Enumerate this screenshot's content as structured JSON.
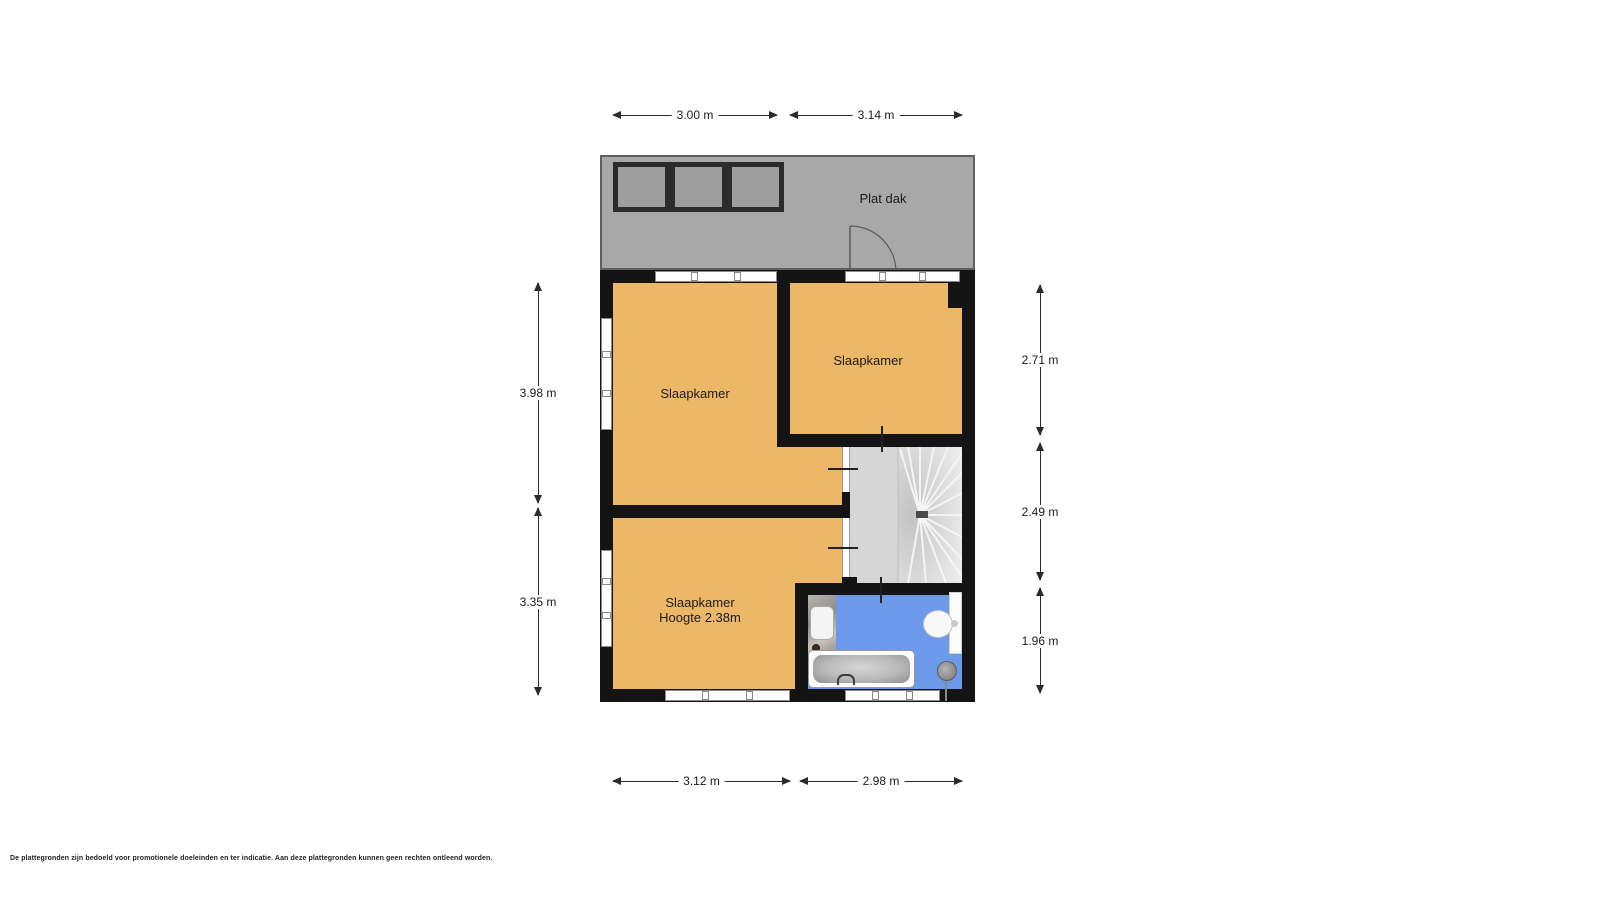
{
  "page": {
    "background": "#ffffff",
    "disclaimer": "De plattegronden zijn bedoeld voor promotionele doeleinden en ter indicatie. Aan deze plattegronden kunnen geen rechten ontleend worden."
  },
  "floorplan": {
    "roof": {
      "label": "Plat dak"
    },
    "rooms": [
      {
        "name": "bedroom-top-left",
        "label": "Slaapkamer"
      },
      {
        "name": "bedroom-top-right",
        "label": "Slaapkamer"
      },
      {
        "name": "bedroom-bottom",
        "label": "Slaapkamer",
        "sublabel": "Hoogte 2.38m"
      }
    ],
    "areas": [
      {
        "name": "landing-with-stairs"
      },
      {
        "name": "bathroom"
      }
    ],
    "fixtures": [
      "staircase",
      "bathtub",
      "sink",
      "toilet",
      "shower-head",
      "roof-door",
      "skylights"
    ],
    "colors": {
      "wall": "#141414",
      "bedroom_fill": "#ecb766",
      "roof_fill": "#a8a8a8",
      "landing_fill": "#d6d6d6",
      "bathroom_fill": "#6c99ea"
    },
    "dimensions": {
      "top": [
        {
          "label": "3.00 m"
        },
        {
          "label": "3.14 m"
        }
      ],
      "bottom": [
        {
          "label": "3.12 m"
        },
        {
          "label": "2.98 m"
        }
      ],
      "left": [
        {
          "label": "3.98 m"
        },
        {
          "label": "3.35 m"
        }
      ],
      "right": [
        {
          "label": "2.71 m"
        },
        {
          "label": "2.49 m"
        },
        {
          "label": "1.96 m"
        }
      ]
    }
  }
}
